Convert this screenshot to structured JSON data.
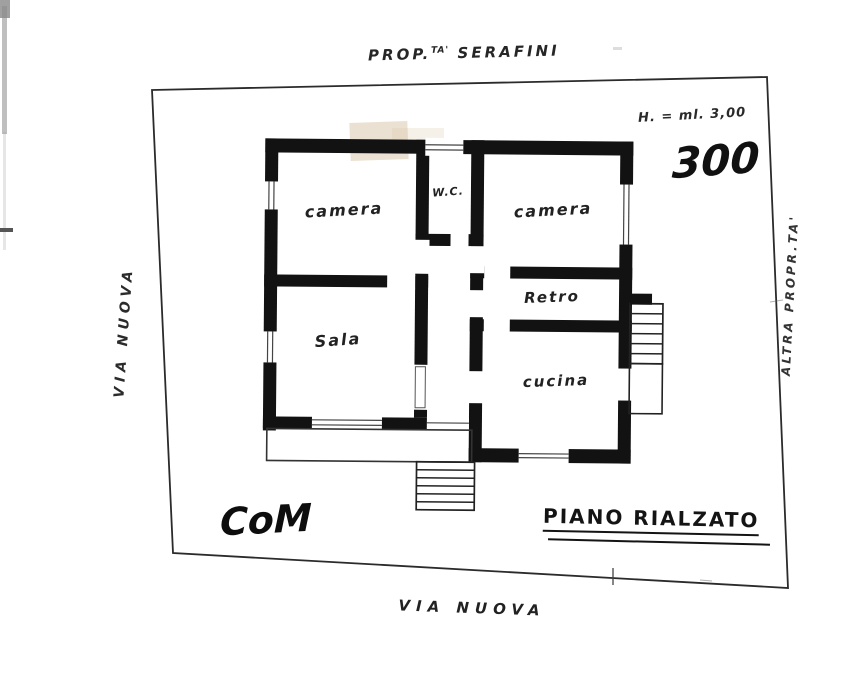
{
  "document": {
    "top_label": {
      "prefix": "PROP.",
      "sup": "TA'",
      "name": "SERAFINI"
    },
    "height_note": "H. = ml. 3,00",
    "area_number": "300",
    "street_left": "VIA NUOVA",
    "street_bottom": "VIA NUOVA",
    "neighbor_label": "ALTRA PROPR.TA'",
    "plan_title": "PIANO RIALZATO",
    "signature": "CoM",
    "rooms": [
      {
        "name": "camera-left",
        "label": "camera"
      },
      {
        "name": "wc",
        "label": "W.C."
      },
      {
        "name": "camera-right",
        "label": "camera"
      },
      {
        "name": "retro",
        "label": "Retro"
      },
      {
        "name": "sala",
        "label": "Sala"
      },
      {
        "name": "cucina",
        "label": "cucina"
      }
    ],
    "colors": {
      "ink": "#141414",
      "paper": "#ffffff",
      "smudge": "#d8c3a5"
    }
  }
}
